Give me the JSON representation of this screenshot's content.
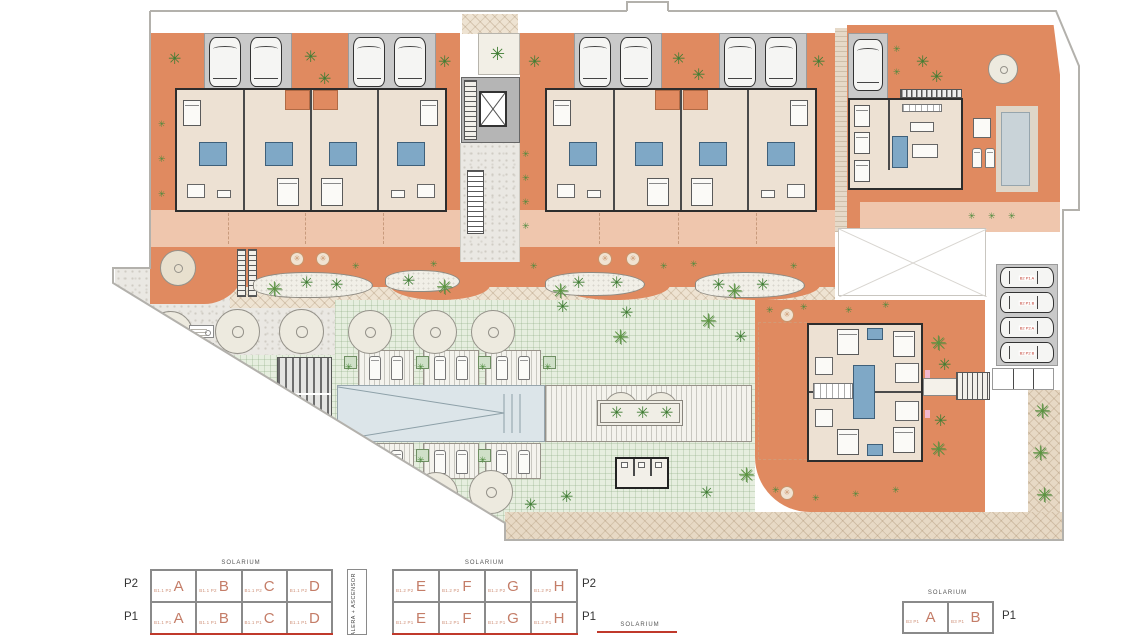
{
  "palette": {
    "terracotta": "#e08a60",
    "salmon": "#efc6ad",
    "building": "#ede1d3",
    "wall": "#2d2d2d",
    "pool": "#dce5e9",
    "lawn": "#e6eedf",
    "plant_green": "#3f7d33",
    "legend_red": "#c47d68",
    "parking_gray": "#c9c9c9",
    "path_tan": "#e7d9c5"
  },
  "icons": {
    "plant": "✳",
    "palm": "✳",
    "flower": "✳"
  },
  "legends": {
    "elevator": "ESCALERA + ASCENSOR",
    "strip_solarium": "SOLARIUM",
    "b11": {
      "solarium": "SOLARIUM",
      "rows": [
        {
          "floor": "P2",
          "cells": [
            {
              "code": "B1.1 P2",
              "letter": "A"
            },
            {
              "code": "B1.1 P2",
              "letter": "B"
            },
            {
              "code": "B1.1 P2",
              "letter": "C"
            },
            {
              "code": "B1.1 P2",
              "letter": "D"
            }
          ]
        },
        {
          "floor": "P1",
          "cells": [
            {
              "code": "B1.1 P1",
              "letter": "A"
            },
            {
              "code": "B1.1 P1",
              "letter": "B"
            },
            {
              "code": "B1.1 P1",
              "letter": "C"
            },
            {
              "code": "B1.1 P1",
              "letter": "D"
            }
          ]
        }
      ]
    },
    "b12": {
      "solarium": "SOLARIUM",
      "rows": [
        {
          "floor": "P2",
          "cells": [
            {
              "code": "B1.2 P2",
              "letter": "E"
            },
            {
              "code": "B1.2 P2",
              "letter": "F"
            },
            {
              "code": "B1.2 P2",
              "letter": "G"
            },
            {
              "code": "B1.2 P2",
              "letter": "H"
            }
          ]
        },
        {
          "floor": "P1",
          "cells": [
            {
              "code": "B1.2 P1",
              "letter": "E"
            },
            {
              "code": "B1.2 P1",
              "letter": "F"
            },
            {
              "code": "B1.2 P1",
              "letter": "G"
            },
            {
              "code": "B1.2 P1",
              "letter": "H"
            }
          ]
        }
      ]
    },
    "b3": {
      "solarium": "SOLARIUM",
      "floor": "P1",
      "cells": [
        {
          "code": "B3 P1",
          "letter": "A"
        },
        {
          "code": "B3 P1",
          "letter": "B"
        }
      ]
    }
  },
  "parking": {
    "labels": [
      "B2 P1 A",
      "B2 P1 B",
      "B2 P2 A",
      "B2 P2 B"
    ]
  }
}
